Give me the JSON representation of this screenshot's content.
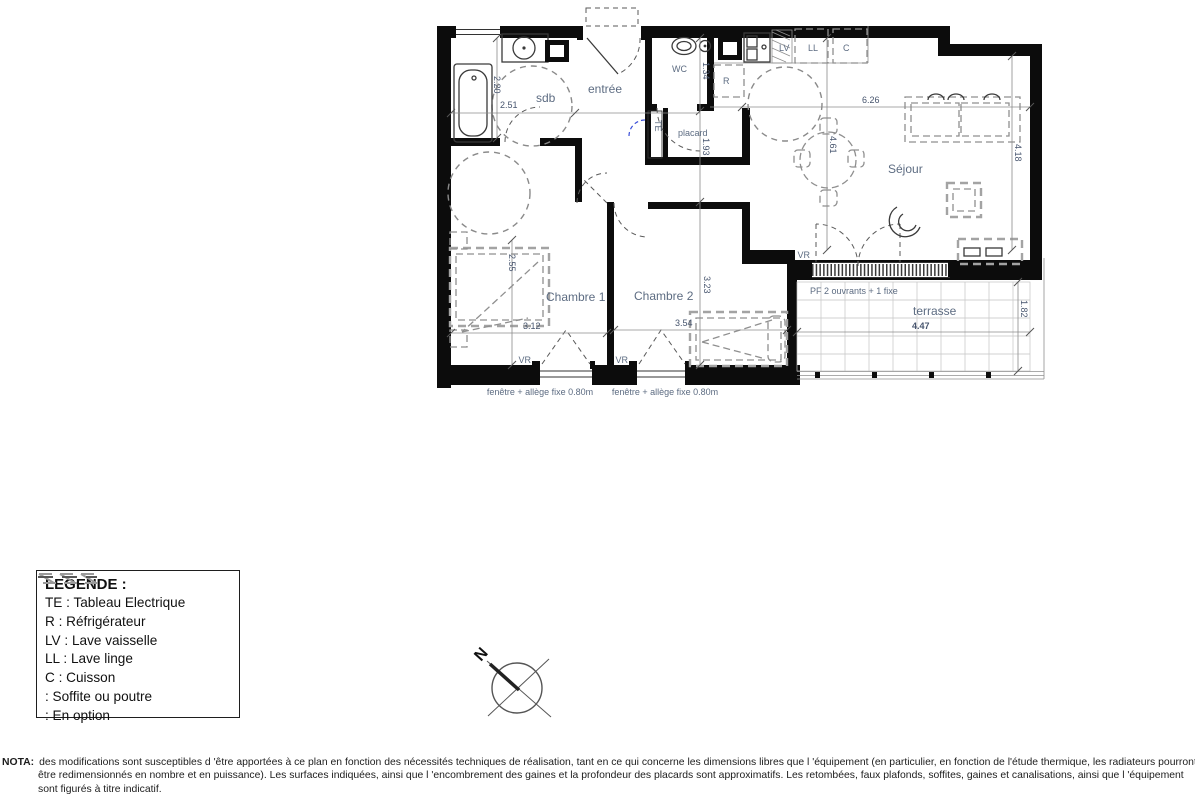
{
  "plan": {
    "rooms": {
      "sdb": "sdb",
      "entree": "entrée",
      "wc": "WC",
      "placard": "placard",
      "sejour": "Séjour",
      "chambre1": "Chambre 1",
      "chambre2": "Chambre 2",
      "terrasse": "terrasse"
    },
    "appliances": {
      "te": "TE",
      "r": "R",
      "lv": "LV",
      "ll": "LL",
      "c": "C"
    },
    "dims": {
      "sdb_height": "2.20",
      "sdb_width": "2.51",
      "wc_height": "1.34",
      "hall_height": "1.93",
      "sejour_width": "6.26",
      "sejour_height_left": "4.61",
      "sejour_height_right": "4.18",
      "chambre1_height": "2.55",
      "chambre1_width": "3.12",
      "chambre2_width": "3.54",
      "chambre2_height": "3.23",
      "terrasse_width": "4.47",
      "terrasse_height": "1.82"
    },
    "windows": {
      "vr": "VR",
      "fenetre": "fenêtre + allège fixe 0.80m",
      "pf": "PF 2 ouvrants + 1 fixe"
    },
    "north": "N"
  },
  "legend": {
    "title": "LEGENDE :",
    "items": [
      "TE : Tableau Electrique",
      "R : Réfrigérateur",
      "LV : Lave vaisselle",
      "LL : Lave linge",
      "C : Cuisson"
    ],
    "soffite_label": ": Soffite ou poutre",
    "option_label": ": En option"
  },
  "nota": {
    "prefix": "NOTA:",
    "text": "des modifications sont susceptibles d 'être apportées à ce plan en fonction des nécessités techniques de réalisation, tant en ce qui concerne les dimensions libres que l 'équipement (en particulier, en fonction de l'étude thermique, les radiateurs pourront être redimensionnés en nombre et en puissance). Les surfaces indiquées, ainsi que l 'encombrement des gaines et la profondeur des placards sont approximatifs. Les retombées, faux plafonds, soffites, gaines et canalisations, ainsi que l 'équipement sont figurés à titre indicatif."
  },
  "colors": {
    "wall": "#0c0c0c",
    "label": "#5d6c82",
    "dimension": "#47556e"
  }
}
